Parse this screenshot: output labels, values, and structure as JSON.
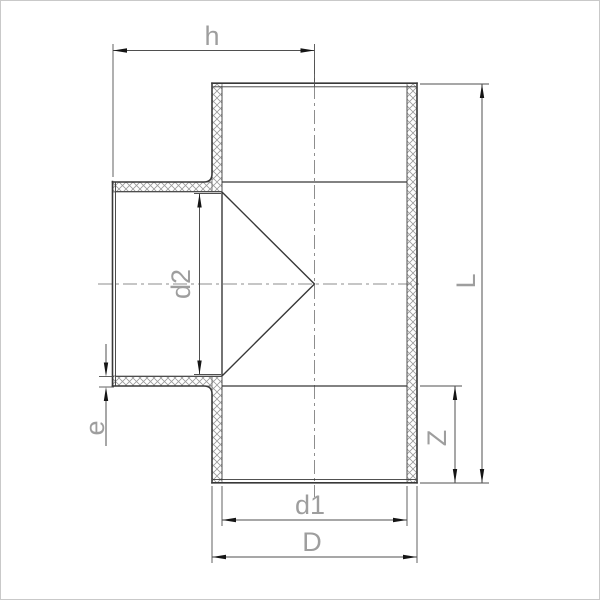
{
  "drawing": {
    "labels": {
      "h": "h",
      "d2": "d2",
      "e": "e",
      "d1": "d1",
      "D": "D",
      "L": "L",
      "Z": "Z"
    },
    "colors": {
      "background": "#ffffff",
      "outline": "#383838",
      "thin_line": "#4d4d4d",
      "hatch": "#9b9b9b",
      "centerline": "#8d8d8d",
      "dimension_line": "#4f4f4f",
      "arrow": "#151515",
      "label_text": "#9e9e9e",
      "frame": "#c9c9c9"
    }
  }
}
